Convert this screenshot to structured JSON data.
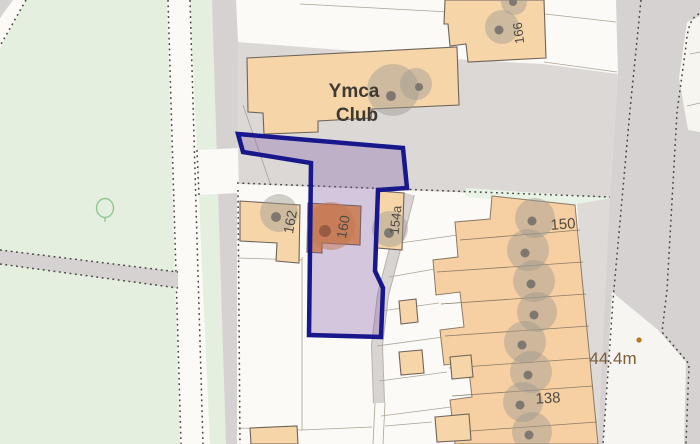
{
  "map": {
    "labels": {
      "ymca_line1": "Ymca",
      "ymca_line2": "Club",
      "b166": "166",
      "b162": "162",
      "b160": "160",
      "b154a": "154a",
      "b150": "150",
      "b138": "138",
      "spot_height": "44.4m"
    },
    "colors": {
      "boundary_stroke": "#18188c",
      "boundary_fill": "rgba(130,95,170,0.33)",
      "highlight_building": "#ef9a3e",
      "building": "#f6d5a9",
      "green_space": "#e4efe0",
      "road": "#d6d2d1",
      "spot_height_text": "#7b5c38"
    },
    "icons": {
      "tree": "deciduous-tree-outline",
      "tree_canopy": "tree-canopy-circle",
      "spot_height_marker": "spot-height-dot",
      "path_edge": "dashed-boundary-line"
    }
  }
}
